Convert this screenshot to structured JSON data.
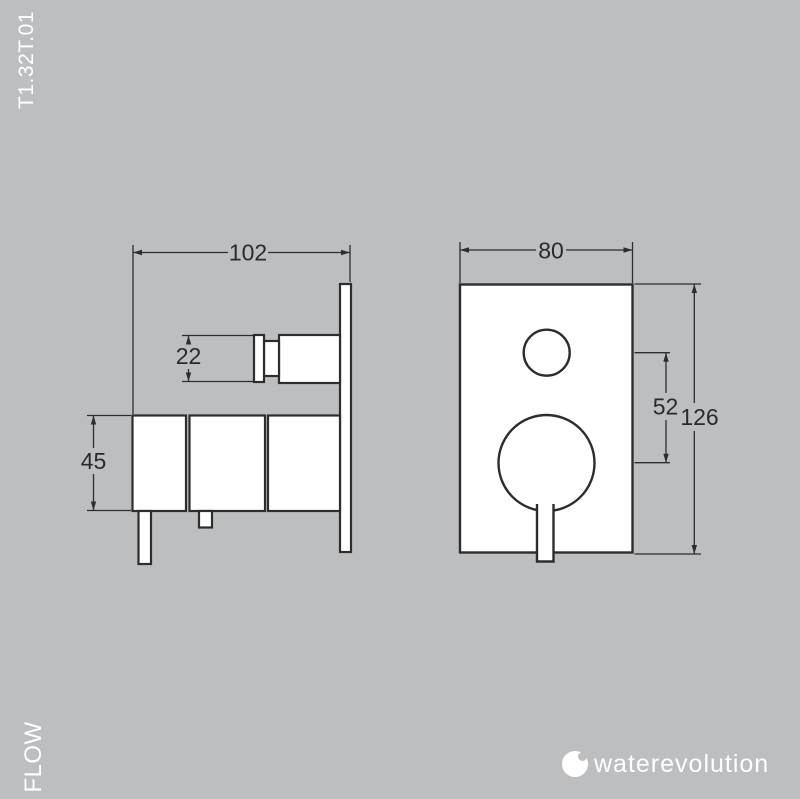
{
  "colors": {
    "background": "#bcbec0",
    "line": "#2d2d2e",
    "dim_text": "#2a2a2a",
    "label_text": "#ffffff",
    "fill": "#ffffff"
  },
  "labels": {
    "product_code": "T1.32T.01",
    "flow": "FLOW"
  },
  "dimensions": {
    "side_depth": "102",
    "knob_diameter": "22",
    "body_height": "45",
    "front_width": "80",
    "handle_centers": "52",
    "plate_height": "126"
  },
  "logo": {
    "brand": "waterevolution"
  }
}
